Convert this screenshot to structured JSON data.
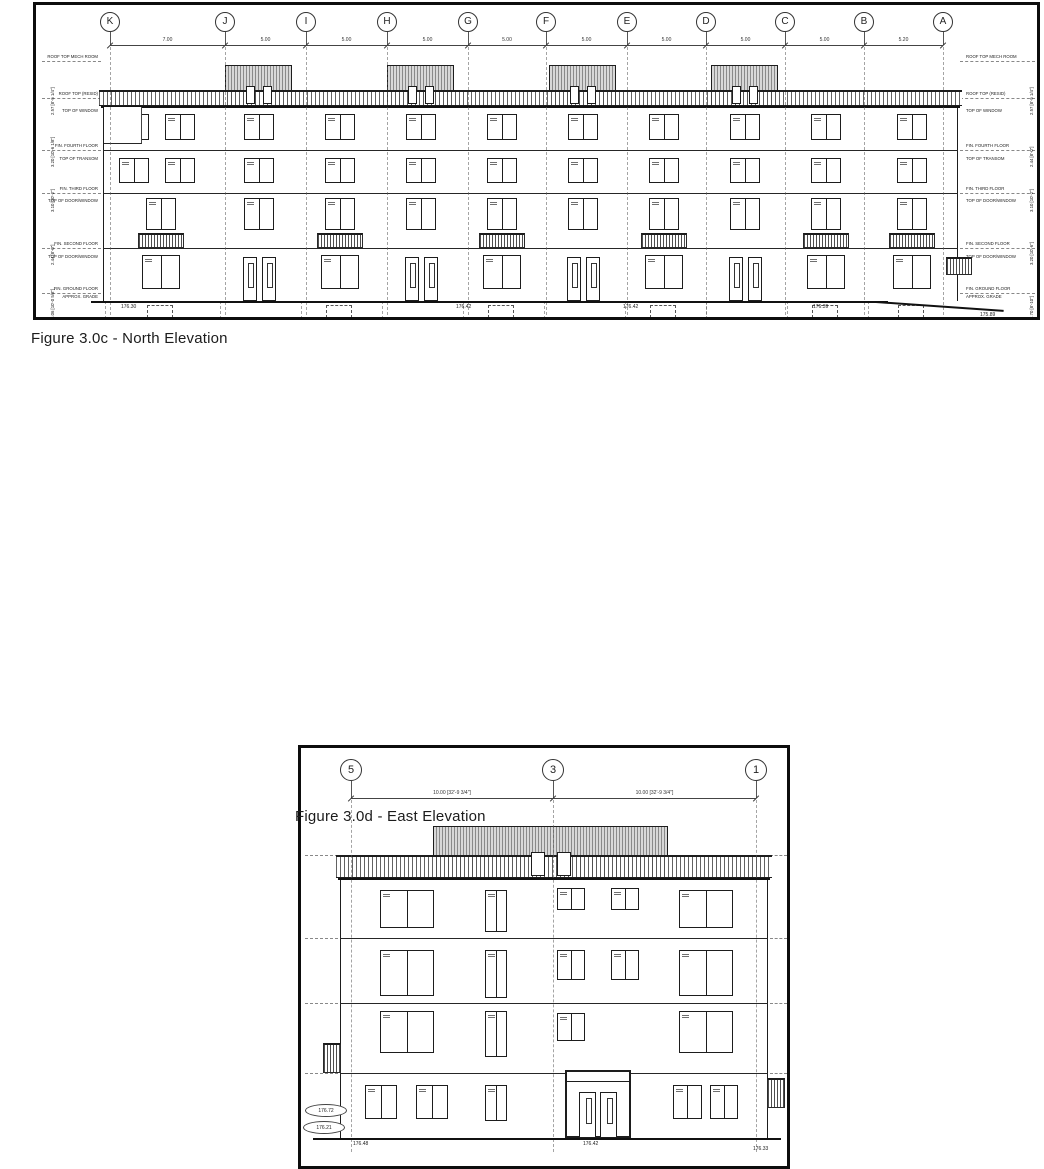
{
  "figure_north": {
    "caption": "Figure 3.0c - North Elevation",
    "frame": {
      "left": 33,
      "top": 2,
      "width": 1007,
      "height": 318
    },
    "grid_labels": [
      "K",
      "J",
      "I",
      "H",
      "G",
      "F",
      "E",
      "D",
      "C",
      "B",
      "A"
    ],
    "grid_x": [
      74,
      189,
      270,
      351,
      432,
      510,
      591,
      670,
      749,
      828,
      907
    ],
    "grid_spacings": [
      "7.00",
      "5.00",
      "5.00",
      "5.00",
      "5.00",
      "5.00",
      "5.00",
      "5.00",
      "5.00",
      "5.20"
    ],
    "bubble_y": 7,
    "bubble_d": 20,
    "dim_y": 40,
    "levels": [
      {
        "y": 56,
        "label": "ROOF TOP MECH ROOM",
        "line": true
      },
      {
        "y": 93,
        "label": "ROOF TOP (RESID)",
        "line": true
      },
      {
        "y": 110,
        "label": "TOP OF WINDOW",
        "line": false
      },
      {
        "y": 145,
        "label": "FIN. FOURTH FLOOR",
        "line": true
      },
      {
        "y": 158,
        "label": "TOP OF TRANSOM",
        "line": false
      },
      {
        "y": 188,
        "label": "FIN. THIRD FLOOR",
        "line": true
      },
      {
        "y": 200,
        "label": "TOP OF DOOR/WINDOW",
        "line": false
      },
      {
        "y": 243,
        "label": "FIN. SECOND FLOOR",
        "line": true
      },
      {
        "y": 256,
        "label": "TOP OF DOOR/WINDOW",
        "line": false
      },
      {
        "y": 288,
        "label": "FIN. GROUND FLOOR",
        "line": true
      },
      {
        "y": 296,
        "label": "APPROX. GRADE",
        "line": false
      }
    ],
    "vdims_left": [
      {
        "t": "2.57 [8'-5 1/4\"]",
        "y": 88
      },
      {
        "t": "3.20 [10'-6 1/8\"]",
        "y": 140
      },
      {
        "t": "3.10 [10'-2\"]",
        "y": 185
      },
      {
        "t": "2.44 [8'-0\"]",
        "y": 238
      },
      {
        "t": "3.06 [10'-0 5/8\"]",
        "y": 292
      }
    ],
    "vdims_right": [
      {
        "t": "2.57 [8'-5 1/4\"]",
        "y": 88
      },
      {
        "t": "2.44 [8'-0\"]",
        "y": 140
      },
      {
        "t": "3.10 [10'-2\"]",
        "y": 185
      },
      {
        "t": "3.20 [10'-6\"]",
        "y": 238
      },
      {
        "t": "2.70 [8'-10\"]",
        "y": 292
      }
    ],
    "spot_elevations": [
      {
        "x": 85,
        "y": 299,
        "t": "176.30"
      },
      {
        "x": 420,
        "y": 299,
        "t": "176.42"
      },
      {
        "x": 587,
        "y": 299,
        "t": "176.42"
      },
      {
        "x": 777,
        "y": 299,
        "t": "176.39"
      },
      {
        "x": 944,
        "y": 307,
        "t": "175.89"
      }
    ],
    "building": {
      "x": 67,
      "w": 855,
      "pent_y": 60,
      "pent_h": 41,
      "rail_y": 85,
      "rail_h": 16,
      "floor_ys": [
        101,
        145,
        188,
        243,
        296
      ],
      "slab_ys": [
        145,
        188,
        243
      ],
      "grade_y": 296,
      "setback_w": 38,
      "setback_to": 138,
      "bays": [
        {
          "w": 115,
          "f": [
            "h",
            "h",
            "b",
            "b"
          ],
          "balcony": true,
          "basement": true
        },
        {
          "w": 81,
          "f": [
            "v",
            "v",
            "v",
            "b"
          ],
          "doors": true,
          "penthouse": true
        },
        {
          "w": 81,
          "f": [
            "h",
            "h",
            "b",
            "b"
          ],
          "balcony": true,
          "basement": true
        },
        {
          "w": 81,
          "f": [
            "vd",
            "vd",
            "vd",
            "b"
          ],
          "doors": true,
          "penthouse": true
        },
        {
          "w": 81,
          "f": [
            "h",
            "h",
            "b",
            "b"
          ],
          "balcony": true,
          "basement": true
        },
        {
          "w": 81,
          "f": [
            "v",
            "v",
            "v",
            "b"
          ],
          "doors": true,
          "penthouse": true
        },
        {
          "w": 81,
          "f": [
            "h",
            "h",
            "b",
            "b"
          ],
          "balcony": true,
          "basement": true
        },
        {
          "w": 81,
          "f": [
            "vd",
            "vd",
            "vd",
            "b"
          ],
          "doors": true,
          "penthouse": true
        },
        {
          "w": 81,
          "f": [
            "h",
            "h",
            "b",
            "b"
          ],
          "balcony": true,
          "basement": true
        },
        {
          "w": 92,
          "f": [
            "h",
            "h",
            "b",
            "b"
          ],
          "balcony": true,
          "basement": true
        }
      ]
    }
  },
  "figure_east": {
    "caption": "Figure 3.0d - East Elevation",
    "frame": {
      "left": 298,
      "top": 375,
      "width": 492,
      "height": 424
    },
    "grid_labels": [
      "5",
      "3",
      "1"
    ],
    "grid_x": [
      50,
      252,
      455
    ],
    "grid_spacings": [
      "10.00 [32'-9 3/4\"]",
      "10.00 [32'-9 3/4\"]"
    ],
    "bubble_y": 11,
    "bubble_d": 22,
    "dim_y": 50,
    "level_lines_left": [
      107,
      190,
      255,
      325,
      362
    ],
    "level_lines_right": [
      107,
      190,
      255,
      325
    ],
    "spot_elevations": [
      {
        "x": 52,
        "y": 393,
        "t": "176.48"
      },
      {
        "x": 282,
        "y": 393,
        "t": "176.42"
      },
      {
        "x": 452,
        "y": 398,
        "t": "176.33"
      }
    ],
    "oval_spots": [
      {
        "t": "176.72"
      },
      {
        "t": "176.21"
      }
    ],
    "building": {
      "x": 39,
      "w": 428,
      "pent_x": 132,
      "pent_w": 235,
      "pent_y": 78,
      "pent_h": 52,
      "rail_y": 107,
      "rail_h": 23,
      "floor_ys": [
        130,
        190,
        255,
        325,
        390
      ],
      "slab_ys": [
        190,
        255,
        325
      ],
      "grade_y": 390,
      "bays": [
        {
          "w": 15,
          "f": [
            "h",
            "h",
            "b",
            "b"
          ],
          "nowin": true,
          "balcony_left": true
        },
        {
          "w": 103,
          "f": [
            "v",
            "v",
            "v",
            "b"
          ],
          "bigwin": true
        },
        {
          "w": 75,
          "f": [
            "vd",
            "vd",
            "vd",
            "b"
          ],
          "narrow": true
        },
        {
          "w": 130,
          "f": [
            "h",
            "h",
            "b",
            "b"
          ],
          "twin": true,
          "entrance": true
        },
        {
          "w": 85,
          "f": [
            "vd",
            "vd",
            "vd",
            "b"
          ],
          "bigwin": true
        },
        {
          "w": 20,
          "f": [
            "v",
            "b",
            "b",
            "b"
          ],
          "nowin": true,
          "balcony_right": true
        }
      ]
    }
  }
}
